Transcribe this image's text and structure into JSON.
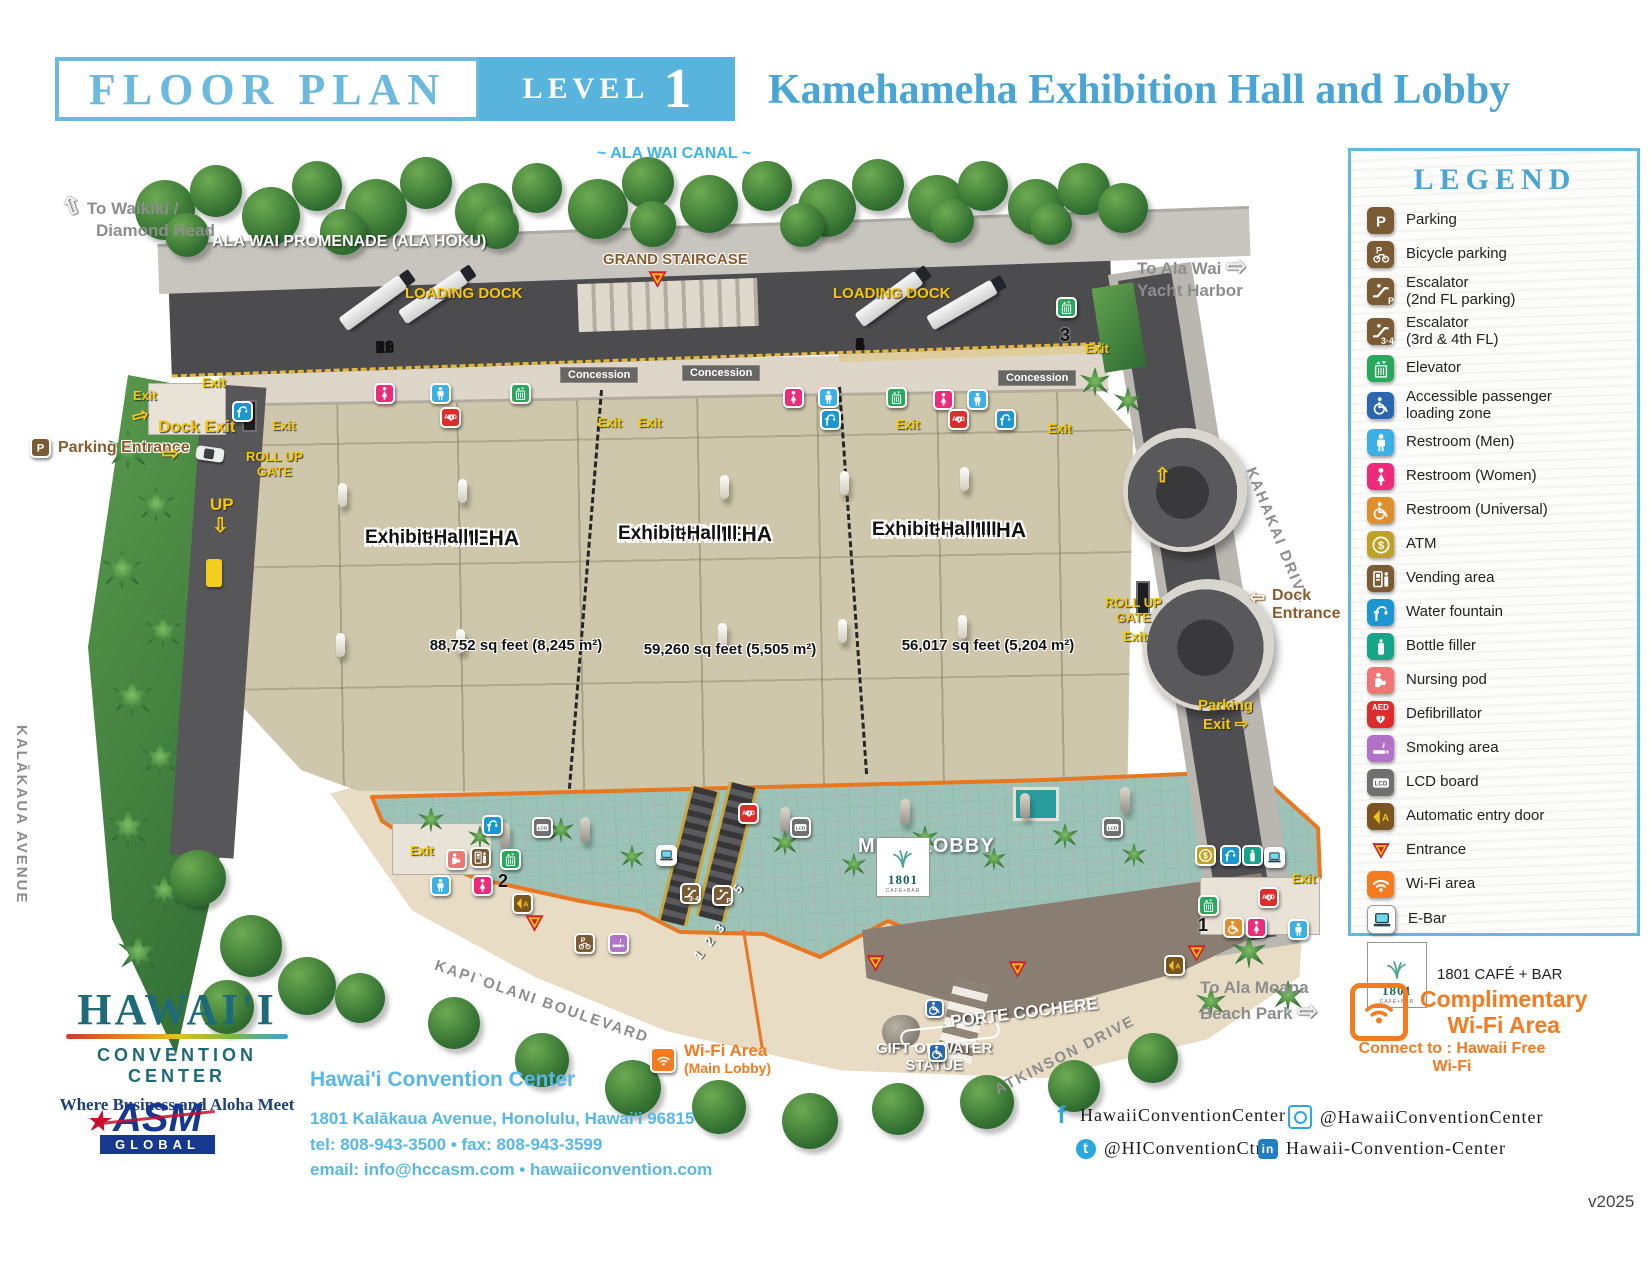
{
  "header": {
    "floor_plan": "FLOOR PLAN",
    "level_label": "LEVEL",
    "level_number": "1",
    "title": "Kamehameha Exhibition Hall and Lobby"
  },
  "map": {
    "ala_wai_canal": "~ ALA WAI CANAL ~",
    "to_waikiki_1": "To Waikīkī /",
    "to_waikiki_2": "Diamond Head",
    "promenade": "ALA WAI PROMENADE (ALA HOKU)",
    "grand_staircase": "GRAND STAIRCASE",
    "loading_dock": "LOADING DOCK",
    "dock_numbers_left": [
      "12",
      "11",
      "10",
      "9",
      "8",
      "7"
    ],
    "dock_numbers_right": [
      "6",
      "5",
      "4",
      "3",
      "2",
      "1"
    ],
    "to_ala_wai_1": "To Ala Wai",
    "to_ala_wai_2": "Yacht Harbor",
    "concession": "Concession",
    "exit": "Exit",
    "dock_exit": "Dock Exit",
    "parking_entrance": "Parking Entrance",
    "roll_up_gate_1": "ROLL UP",
    "roll_up_gate_2": "GATE",
    "up": "UP",
    "kalakaua": "KALĀKAUA AVENUE",
    "kahakai": "KAHAKAI DRIVE",
    "kapiolani": "KAPI`OLANI BOULEVARD",
    "atkinson": "ATKINSON DRIVE",
    "dock_entrance_1": "Dock",
    "dock_entrance_2": "Entrance",
    "parking_exit_1": "Parking",
    "parking_exit_2": "Exit",
    "halls": [
      {
        "line1": "KAMEHAMEHA",
        "line2": "Exhibit Hall I",
        "area": "88,752 sq feet  (8,245 m²)"
      },
      {
        "line1": "KAMEHAMEHA",
        "line2": "Exhibit Hall II",
        "area": "59,260 sq feet  (5,505 m²)"
      },
      {
        "line1": "KAMEHAMEHA",
        "line2": "Exhibit Hall III",
        "area": "56,017 sq feet  (5,204 m²)"
      }
    ],
    "main_lobby": "MAIN LOBBY",
    "elevator_numbers": {
      "one": "1",
      "two": "2",
      "three": "3"
    },
    "escalator_numbers_123": "1 2 3",
    "escalator_numbers_45": "4 5",
    "porte_cochere": "PORTE COCHERE",
    "gift_of_water_1": "GIFT OF WATER",
    "gift_of_water_2": "STATUE",
    "to_ala_moana_1": "To Ala Moana",
    "to_ala_moana_2": "Beach Park",
    "wifi_area_1": "Wi-Fi Area",
    "wifi_area_2": "(Main Lobby)",
    "cafe": {
      "number": "1801",
      "sub": "CAFÉ+BAR"
    }
  },
  "legend": {
    "title": "LEGEND",
    "items": [
      {
        "name": "parking",
        "icon": "park",
        "color": "#7b5b33",
        "label": "Parking"
      },
      {
        "name": "bicycle-parking",
        "icon": "bike",
        "color": "#7b5b33",
        "label": "Bicycle parking"
      },
      {
        "name": "escalator-2fl",
        "icon": "esc",
        "sub": "P",
        "color": "#7b5b33",
        "label": "Escalator",
        "label2": "(2nd FL parking)"
      },
      {
        "name": "escalator-34fl",
        "icon": "esc",
        "sub": "3·4",
        "color": "#7b5b33",
        "label": "Escalator",
        "label2": "(3rd & 4th FL)"
      },
      {
        "name": "elevator",
        "icon": "elev",
        "color": "#27a95c",
        "label": "Elevator"
      },
      {
        "name": "accessible-loading",
        "icon": "wheel",
        "color": "#2b66ae",
        "label": "Accessible passenger",
        "label2": "loading zone"
      },
      {
        "name": "restroom-men",
        "icon": "man",
        "color": "#3bb0e5",
        "label": "Restroom (Men)"
      },
      {
        "name": "restroom-women",
        "icon": "woman",
        "color": "#ee2a7b",
        "label": "Restroom (Women)"
      },
      {
        "name": "restroom-universal",
        "icon": "wheel",
        "color": "#df8f2d",
        "label": "Restroom (Universal)"
      },
      {
        "name": "atm",
        "icon": "atm",
        "color": "#bfa126",
        "label": "ATM"
      },
      {
        "name": "vending",
        "icon": "vend",
        "color": "#7b5b33",
        "label": "Vending area"
      },
      {
        "name": "water-fountain",
        "icon": "fount",
        "color": "#1b96d1",
        "label": "Water fountain"
      },
      {
        "name": "bottle-filler",
        "icon": "bottle",
        "color": "#17a589",
        "label": "Bottle filler"
      },
      {
        "name": "nursing-pod",
        "icon": "nurse",
        "color": "#f07575",
        "label": "Nursing pod"
      },
      {
        "name": "defibrillator",
        "icon": "aed",
        "color": "#dd2c2c",
        "label": "Defibrillator"
      },
      {
        "name": "smoking-area",
        "icon": "smoke",
        "color": "#b272c8",
        "label": "Smoking area"
      },
      {
        "name": "lcd-board",
        "icon": "lcd",
        "color": "#6f6f6f",
        "label": "LCD board"
      },
      {
        "name": "auto-door",
        "icon": "door",
        "color": "#7a5520",
        "label": "Automatic entry door"
      },
      {
        "name": "entrance",
        "icon": "tri",
        "color": "",
        "label": "Entrance"
      },
      {
        "name": "wifi-area",
        "icon": "wifi",
        "color": "#f47b20",
        "label": "Wi-Fi area"
      },
      {
        "name": "e-bar",
        "icon": "ebar",
        "color": "#ffffff",
        "label": "E-Bar"
      }
    ],
    "cafe_item": {
      "number": "1801",
      "sub": "CAFÉ+BAR",
      "label": "1801 CAFÉ + BAR"
    }
  },
  "wifi_box": {
    "line1": "Complimentary",
    "line2": "Wi-Fi Area",
    "connect": "Connect to : Hawaii Free Wi-Fi"
  },
  "footer": {
    "logo": {
      "name": "HAWAI'I",
      "sub": "CONVENTION CENTER",
      "tagline": "Where Business and Aloha Meet"
    },
    "asm": {
      "name": "ASM",
      "sub": "GLOBAL"
    },
    "org": "Hawai'i Convention Center",
    "address": "1801 Kalākaua Avenue, Honolulu, Hawai'i 96815",
    "phone": "tel: 808-943-3500 • fax: 808-943-3599",
    "email": "email: info@hccasm.com • hawaiiconvention.com",
    "social": {
      "facebook": "HawaiiConventionCenter",
      "instagram": "@HawaiiConventionCenter",
      "twitter": "@HIConventionCtr",
      "linkedin": "Hawaii-Convention-Center"
    },
    "version": "v2025"
  }
}
